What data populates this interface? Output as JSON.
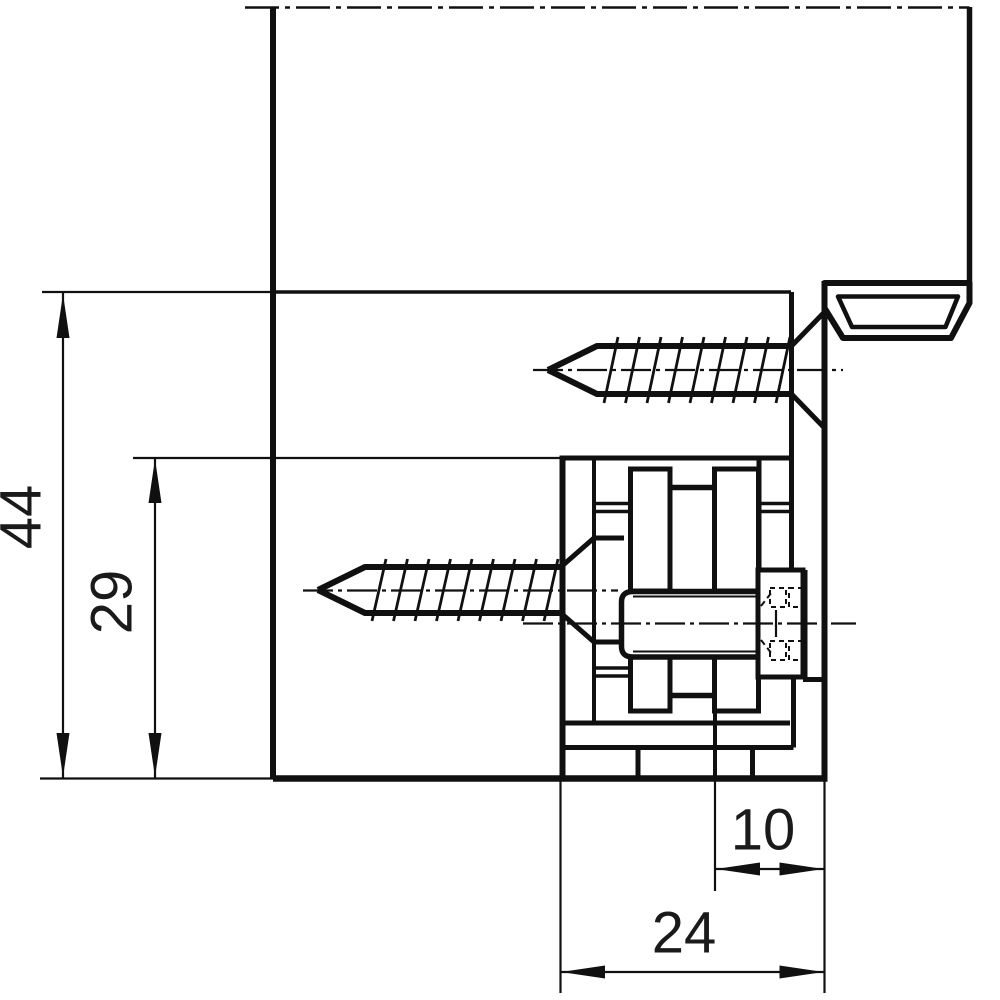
{
  "drawing": {
    "type": "technical-section-drawing",
    "subject": "Concealed door hinge cross-section with frame seal groove and two countersunk fixing screws",
    "background_color": "#ffffff",
    "line_color": "#101010",
    "text_color": "#1a1a1a",
    "dimensions": {
      "overall_height": {
        "label": "44",
        "orientation": "vertical"
      },
      "hinge_body_height": {
        "label": "29",
        "orientation": "vertical"
      },
      "inner_depth": {
        "label": "10",
        "orientation": "horizontal"
      },
      "overall_depth": {
        "label": "24",
        "orientation": "horizontal"
      }
    }
  }
}
